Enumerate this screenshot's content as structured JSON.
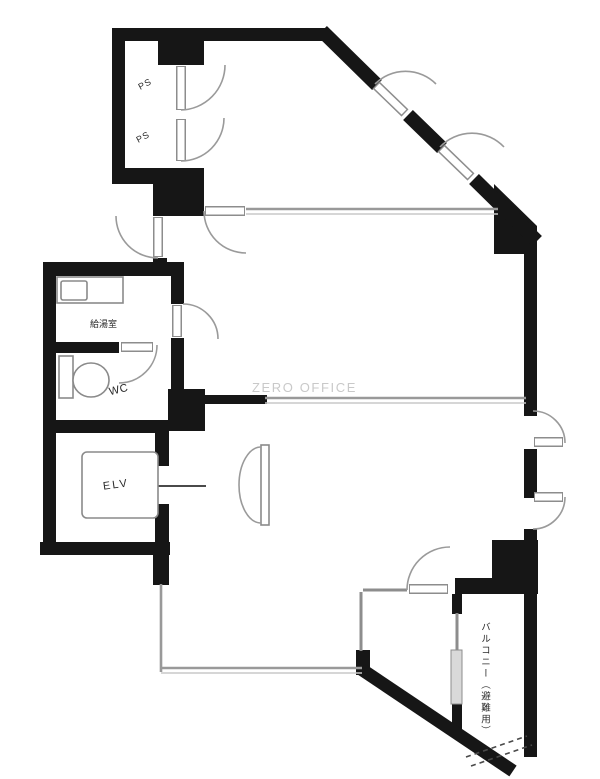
{
  "floorplan": {
    "watermark": "ZERO OFFICE",
    "labels": {
      "ps_top": "PS",
      "ps_bottom": "PS",
      "kitchen": "給湯室",
      "toilet": "WC",
      "elevator": "ELV",
      "balcony": "バルコニー（避難用）"
    },
    "colors": {
      "wall": "#161616",
      "partition": "#999999",
      "partition_light": "#c8c8c8",
      "door": "#9a9a9a",
      "fixture": "#8a8a8a",
      "label": "#2a2a2a",
      "watermark": "#c9c9c9",
      "background": "#ffffff"
    }
  }
}
